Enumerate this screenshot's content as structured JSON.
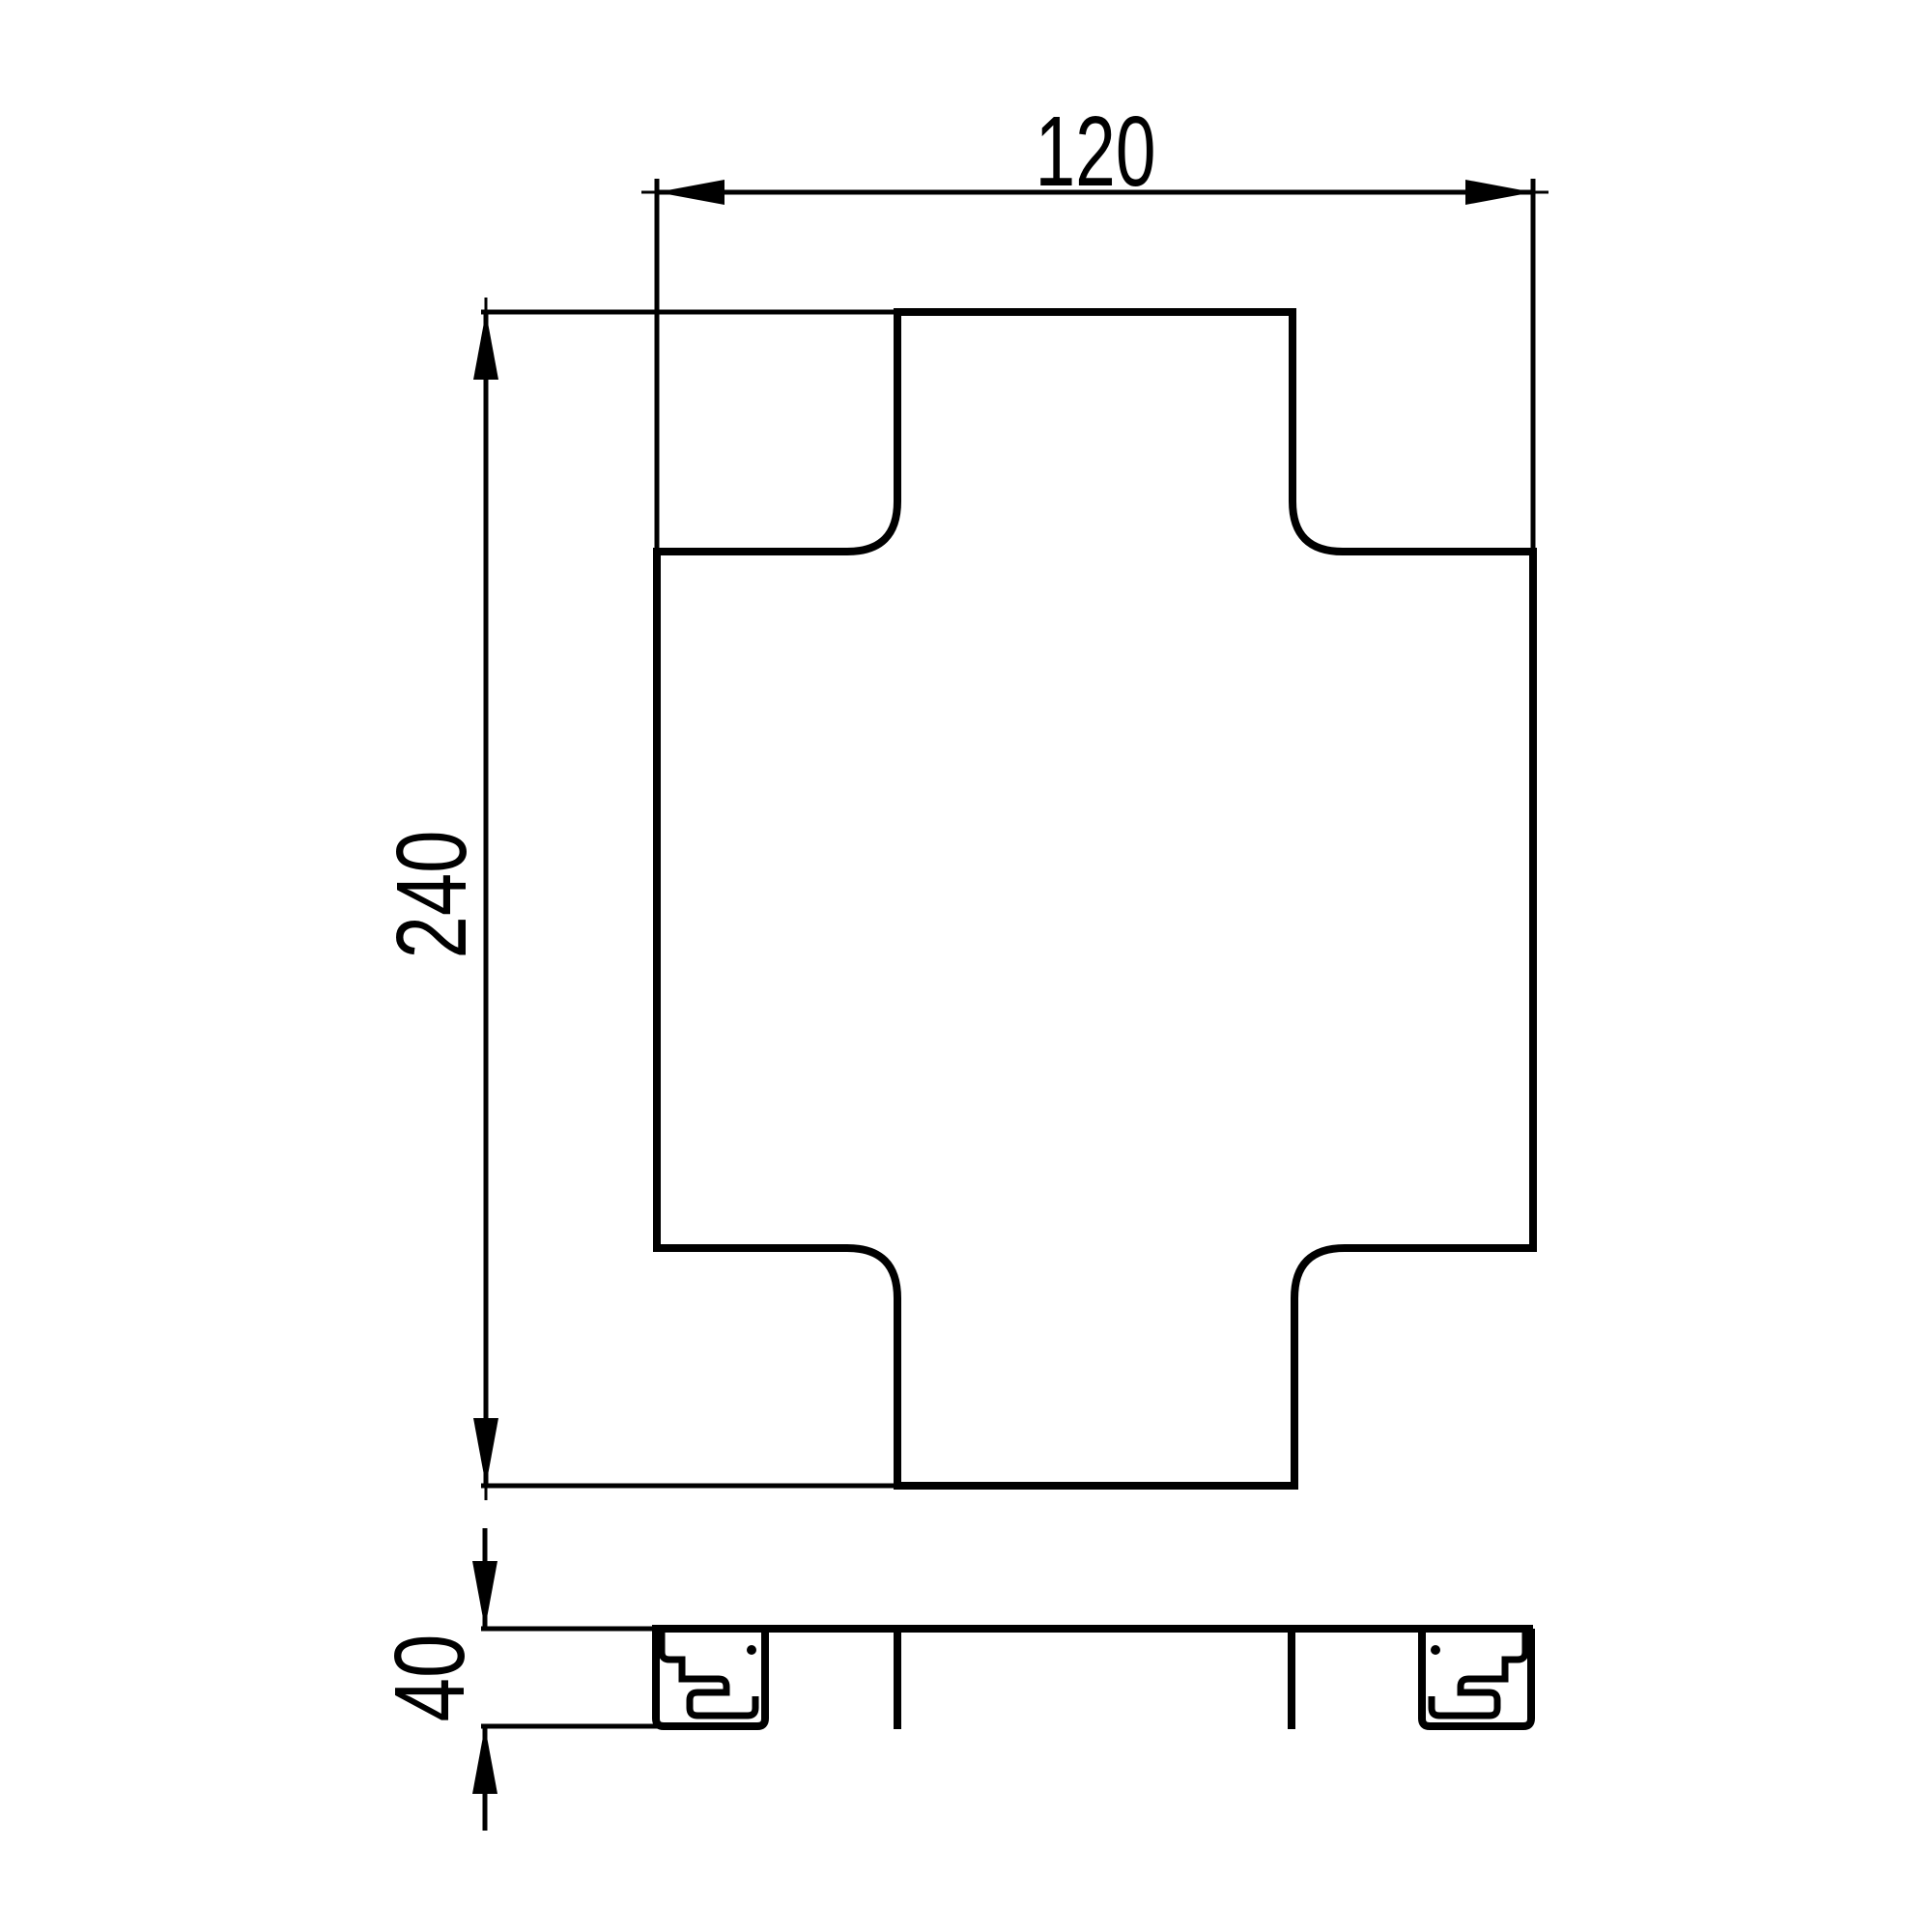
{
  "drawing": {
    "dimensions": {
      "width": "120",
      "height": "240",
      "thickness": "40"
    },
    "colors": {
      "ink": "#000000",
      "paper": "#ffffff"
    }
  }
}
